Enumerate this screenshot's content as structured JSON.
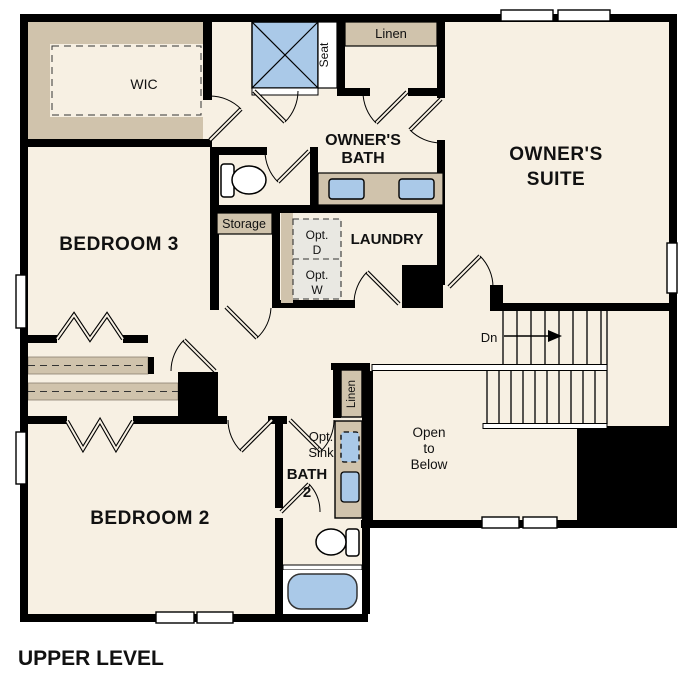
{
  "title": "UPPER LEVEL",
  "plan_name": "upper-level-floor-plan",
  "colors": {
    "walls": "#000000",
    "floor": "#f7f0e3",
    "casework_tan": "#d0c3ac",
    "fixture_blue": "#aac9e8",
    "optional_gray": "#e9e8e2",
    "window_white": "#ffffff"
  },
  "rooms": {
    "wic": {
      "label": "WIC"
    },
    "owners_bath": {
      "line1": "OWNER'S",
      "line2": "BATH"
    },
    "owners_suite": {
      "line1": "OWNER'S",
      "line2": "SUITE"
    },
    "bedroom3": {
      "label": "BEDROOM 3"
    },
    "laundry": {
      "label": "LAUNDRY"
    },
    "bedroom2": {
      "label": "BEDROOM 2"
    },
    "bath2": {
      "line1": "BATH",
      "line2": "2"
    },
    "open_to_below": {
      "line1": "Open",
      "line2": "to",
      "line3": "Below"
    }
  },
  "annotations": {
    "linen_top": "Linen",
    "linen_hall": "Linen",
    "seat": "Seat",
    "storage": "Storage",
    "opt_dryer_line1": "Opt.",
    "opt_dryer_line2": "D",
    "opt_washer_line1": "Opt.",
    "opt_washer_line2": "W",
    "opt_sink_line1": "Opt.",
    "opt_sink_line2": "Sink",
    "stairs_down": "Dn"
  },
  "fixtures": [
    "shower-with-seat",
    "double-vanity-two-sinks",
    "toilet-owners-bath",
    "vanity-with-optional-sink",
    "toilet-bath2",
    "bathtub",
    "optional-washer",
    "optional-dryer",
    "staircase-down"
  ]
}
